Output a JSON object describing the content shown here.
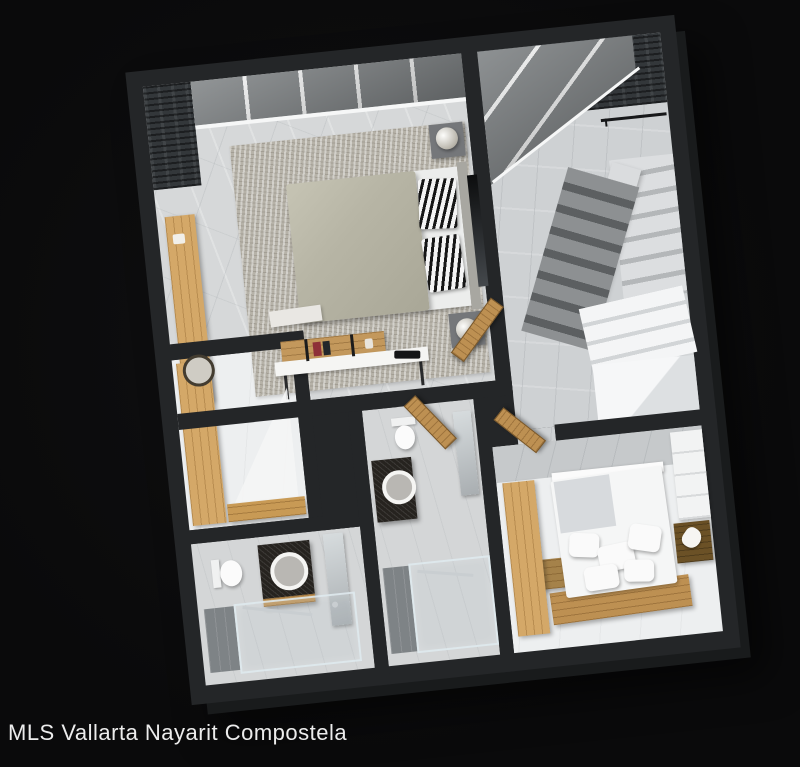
{
  "caption": {
    "text": "MLS Vallarta Nayarit Compostela"
  },
  "palette": {
    "background": "#0a0a0b",
    "wall": "#242628",
    "wall_face": "#191b1c",
    "marble_floor": "#d6d8d9",
    "marble_wall": "#c6c9cb",
    "floor_white": "#edeff0",
    "bath_floor": "#d4d6d7",
    "stair_floor": "#ced1d3",
    "glass": "#7e8284",
    "mullion": "#f6f7f7",
    "slate": "#33373a",
    "wood_light": "#d4a868",
    "wood_mid": "#bd9052",
    "wood_dark": "#6b5126",
    "rug": "#b6b2a8",
    "duvet": "#b7b5a5",
    "linen": "#f5f6f6",
    "zebra_dark": "#161616",
    "granite": "#26231f",
    "tile": "#7e8386",
    "chrome": "#c9ced1",
    "text": "#ececec"
  },
  "scene": {
    "type": "3d-floor-plan-render",
    "rooms": [
      "master-bedroom",
      "stairwell",
      "walk-in-closet",
      "bathroom-1",
      "bathroom-2",
      "bedroom-2"
    ]
  }
}
